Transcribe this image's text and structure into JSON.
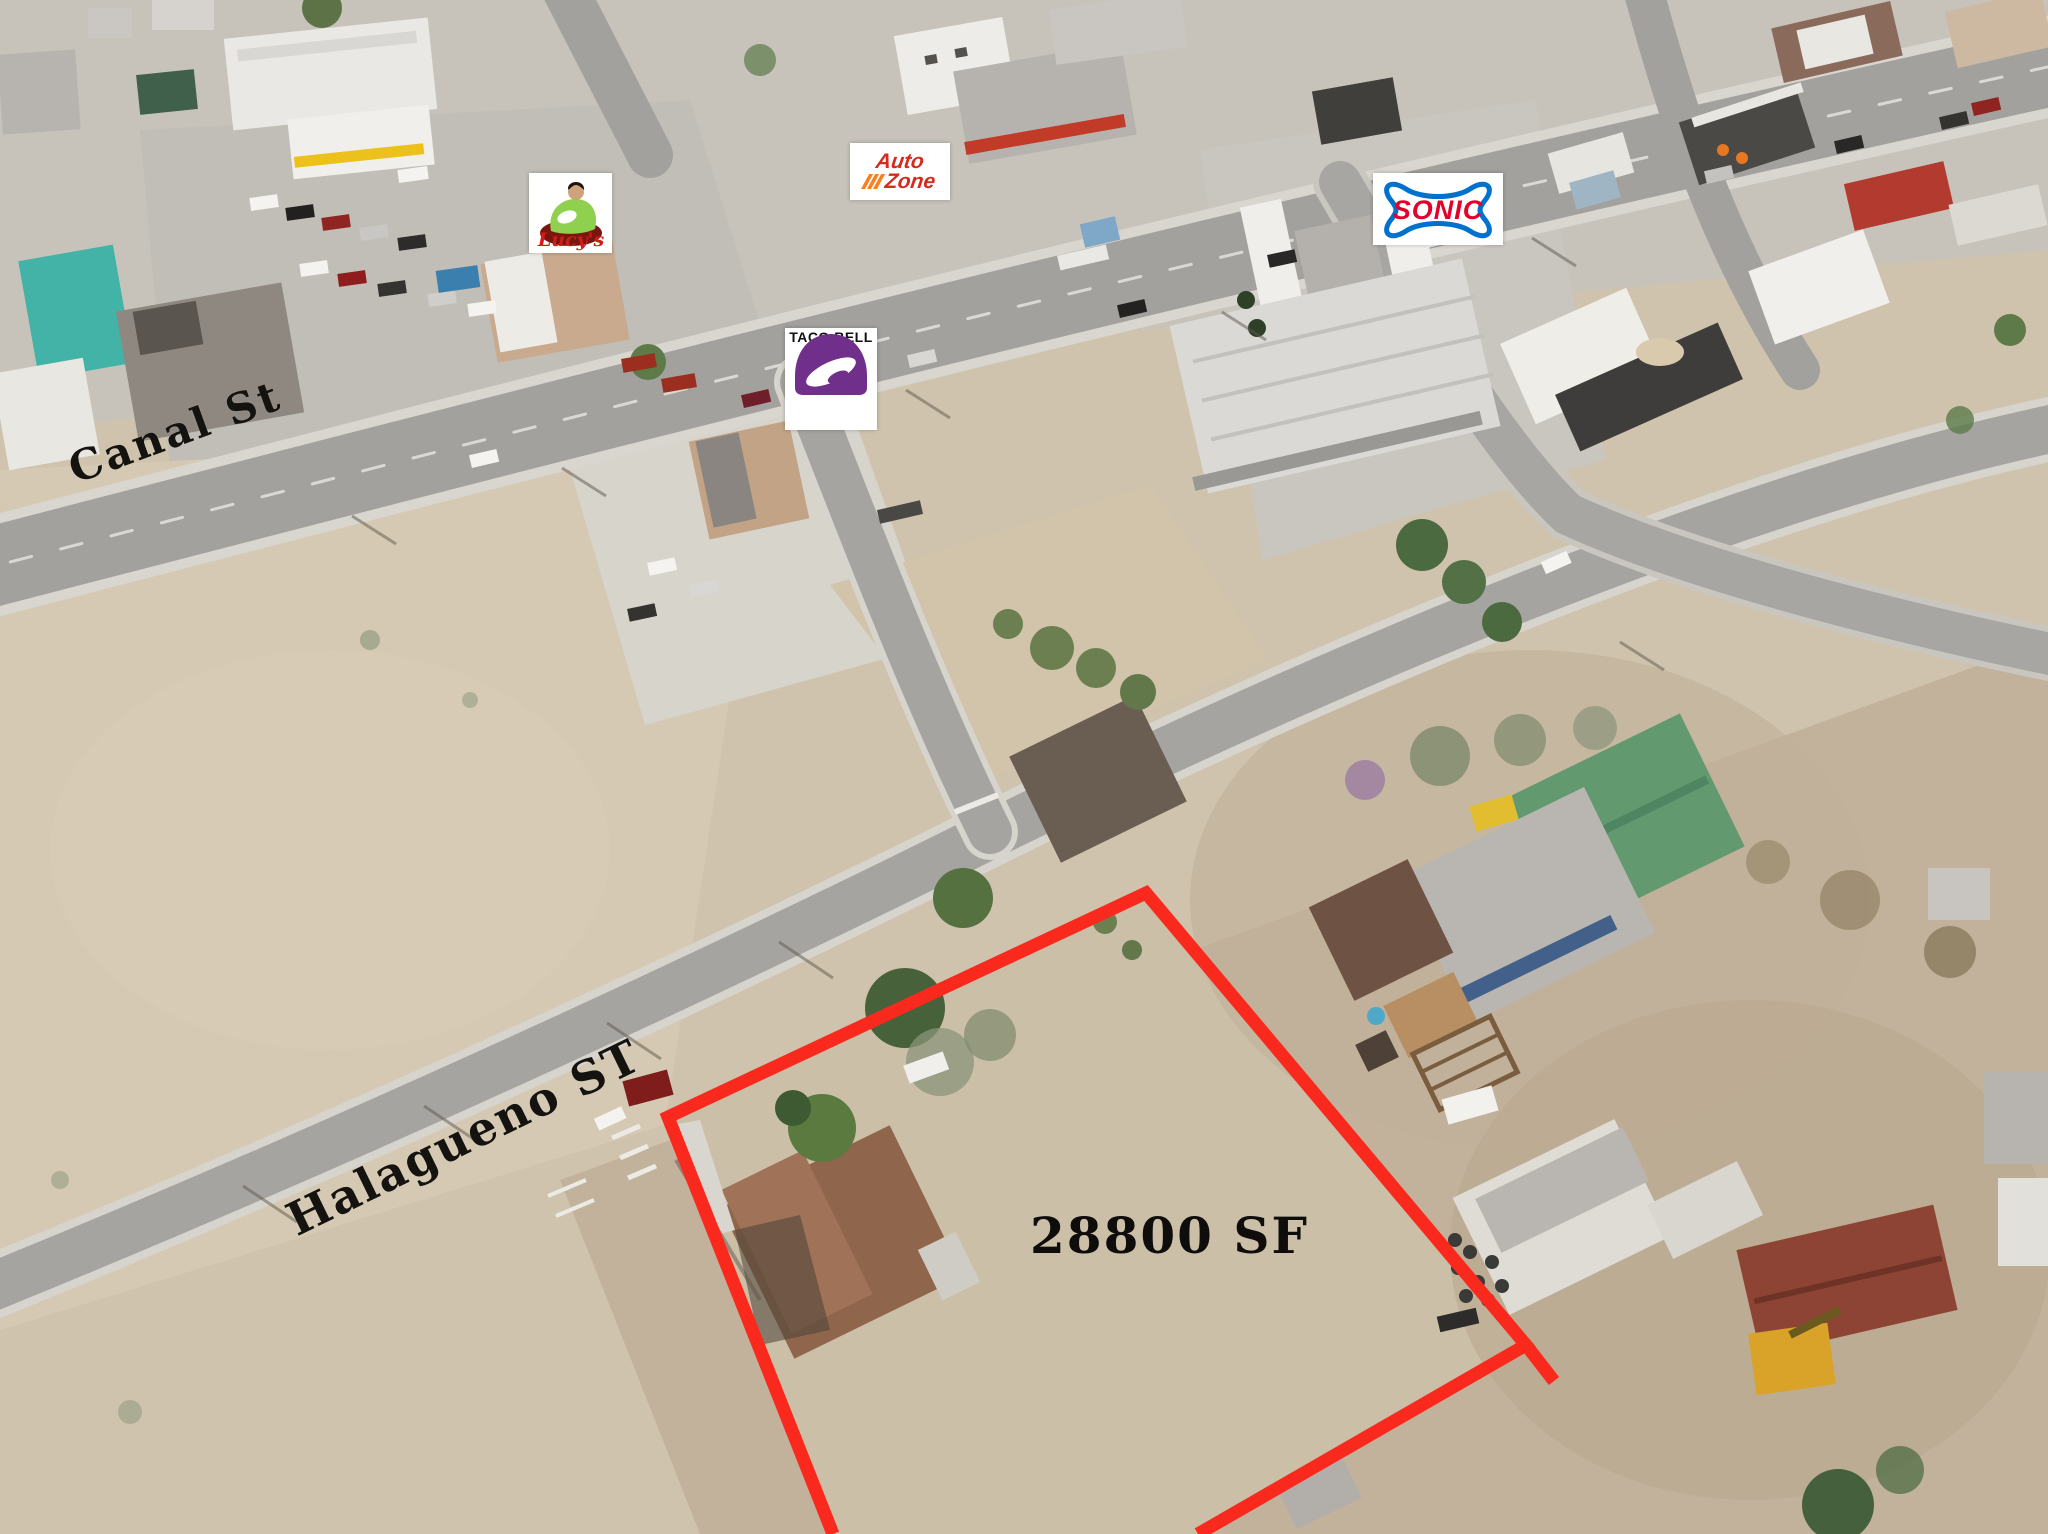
{
  "image": {
    "type": "aerial-property-photo",
    "street_labels": [
      {
        "id": "canal",
        "text": "Canal St"
      },
      {
        "id": "halagueno",
        "text": "Halagueno ST"
      }
    ],
    "parcel": {
      "area_text": "28800 SF",
      "boundary_color": "#fa291d",
      "boundary_points": "833,1534 668,1117 1146,893 1526,1345 1198,1534",
      "boundary_stub_points": "1526,1345 1554,1381"
    },
    "business_logos": [
      {
        "id": "lucys",
        "text": "Lucy's",
        "accent_red": "#cf1d17",
        "dress_green": "#8fd14f"
      },
      {
        "id": "autozone",
        "text_line1": "Auto",
        "text_line2": "Zone",
        "brand_red": "#d52b1e",
        "brand_orange": "#f5821f"
      },
      {
        "id": "sonic",
        "text": "SONIC",
        "brand_red": "#e4002b",
        "brand_blue": "#0072ce"
      },
      {
        "id": "tacobell",
        "text": "TACO BELL",
        "brand_purple": "#702f8a"
      }
    ]
  }
}
